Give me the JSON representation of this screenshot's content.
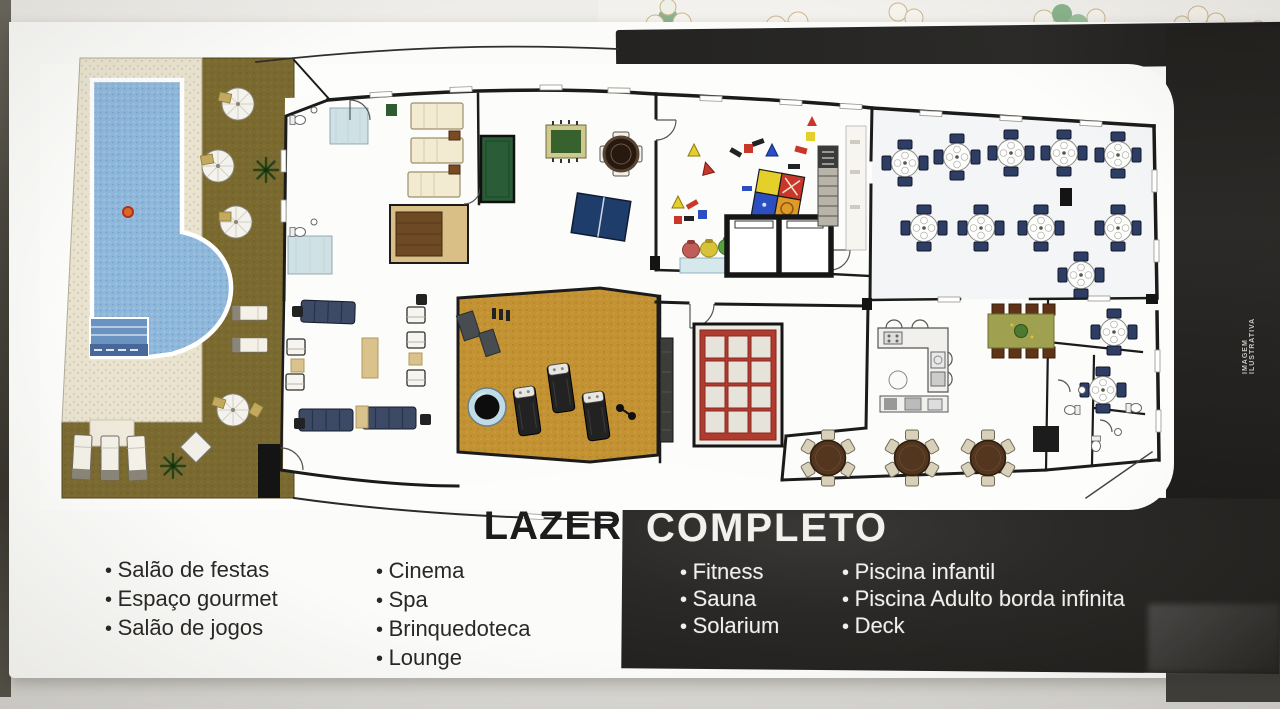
{
  "brochure": {
    "title": {
      "left": "LAZER",
      "right": "COMPLETO"
    },
    "watermark": "IMAGEM ILUSTRATIVA",
    "amenities": {
      "col1": [
        "Salão de festas",
        "Espaço gourmet",
        "Salão de jogos"
      ],
      "col2": [
        "Cinema",
        "Spa",
        "Brinquedoteca",
        "Lounge"
      ],
      "col3": [
        "Fitness",
        "Sauna",
        "Solarium"
      ],
      "col4": [
        "Piscina infantil",
        "Piscina Adulto borda infinita",
        "Deck"
      ]
    }
  },
  "colors": {
    "panel_black": "#232120",
    "pool_blue": "#8fb7da",
    "deck_brown": "#7b6a30",
    "red_door": "#b23b2f",
    "fitness_floor": "#c39233",
    "title_ink": "#1c1c1c",
    "title_on_black": "#f2f1ee"
  }
}
